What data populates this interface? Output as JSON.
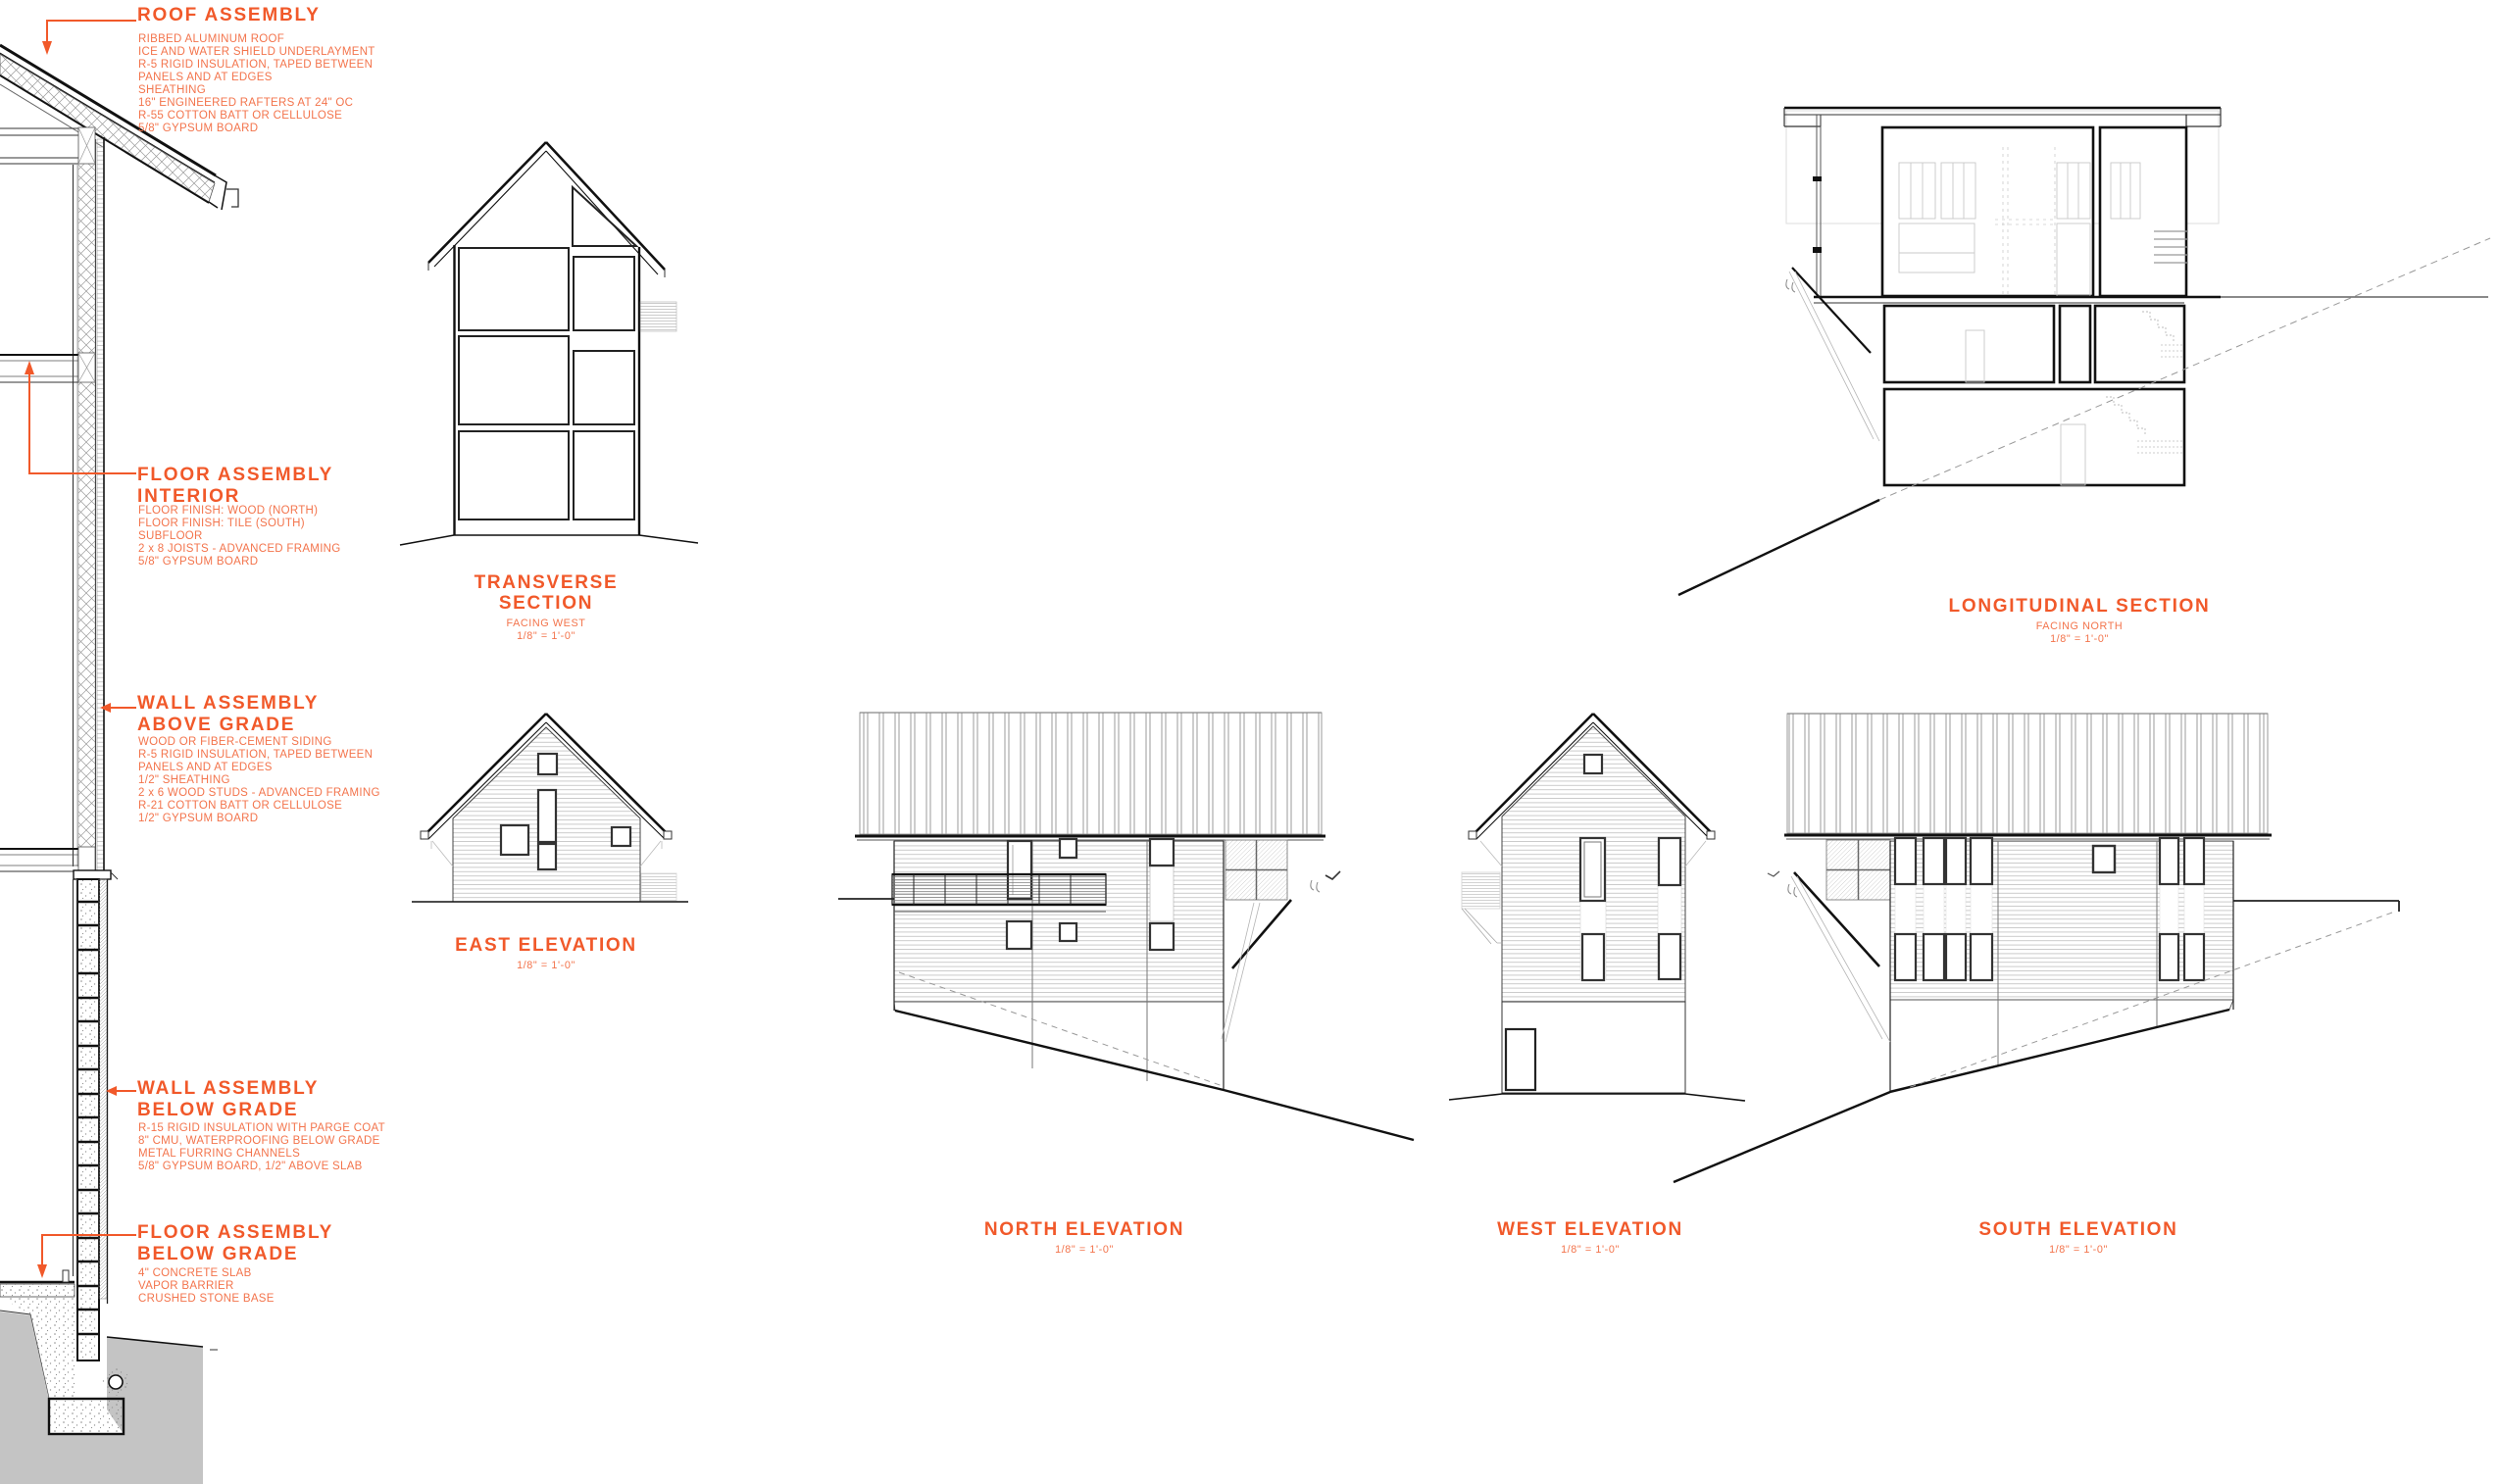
{
  "palette": {
    "accent": "#F1592A",
    "accent_light": "#F3744C",
    "cut_line": "#111111",
    "light_line": "#b5b5b5",
    "earth_gray": "#c4c4c4"
  },
  "callouts": [
    {
      "title": "ROOF ASSEMBLY",
      "lines": [
        "RIBBED ALUMINUM ROOF",
        "ICE AND WATER SHIELD UNDERLAYMENT",
        "R-5 RIGID INSULATION, TAPED BETWEEN",
        "PANELS AND AT EDGES",
        "SHEATHING",
        "16\" ENGINEERED RAFTERS AT 24\" OC",
        "R-55 COTTON BATT OR CELLULOSE",
        "5/8\" GYPSUM BOARD"
      ]
    },
    {
      "title": "FLOOR ASSEMBLY INTERIOR",
      "lines": [
        "FLOOR FINISH: WOOD (NORTH)",
        "FLOOR FINISH: TILE (SOUTH)",
        "SUBFLOOR",
        "2 x 8 JOISTS - ADVANCED FRAMING",
        "5/8\" GYPSUM BOARD"
      ]
    },
    {
      "title": "WALL ASSEMBLY ABOVE GRADE",
      "lines": [
        "WOOD OR FIBER-CEMENT SIDING",
        "R-5 RIGID INSULATION, TAPED BETWEEN",
        "PANELS AND AT EDGES",
        "1/2\" SHEATHING",
        "2 x 6 WOOD STUDS - ADVANCED FRAMING",
        "R-21 COTTON BATT OR CELLULOSE",
        "1/2\" GYPSUM BOARD"
      ]
    },
    {
      "title": "WALL ASSEMBLY BELOW GRADE",
      "lines": [
        "R-15 RIGID INSULATION WITH PARGE COAT",
        "8\" CMU, WATERPROOFING BELOW GRADE",
        "METAL FURRING CHANNELS",
        "5/8\" GYPSUM BOARD, 1/2\" ABOVE SLAB"
      ]
    },
    {
      "title": "FLOOR ASSEMBLY BELOW GRADE",
      "lines": [
        "4\" CONCRETE SLAB",
        "VAPOR BARRIER",
        "CRUSHED STONE BASE"
      ]
    }
  ],
  "drawings": [
    {
      "title": "TRANSVERSE SECTION",
      "subtitle": "FACING WEST",
      "scale": "1/8\" = 1'-0\""
    },
    {
      "title": "LONGITUDINAL SECTION",
      "subtitle": "FACING NORTH",
      "scale": "1/8\" = 1'-0\""
    },
    {
      "title": "EAST ELEVATION",
      "scale": "1/8\" = 1'-0\""
    },
    {
      "title": "NORTH ELEVATION",
      "scale": "1/8\" = 1'-0\""
    },
    {
      "title": "WEST ELEVATION",
      "scale": "1/8\" = 1'-0\""
    },
    {
      "title": "SOUTH ELEVATION",
      "scale": "1/8\" = 1'-0\""
    }
  ]
}
